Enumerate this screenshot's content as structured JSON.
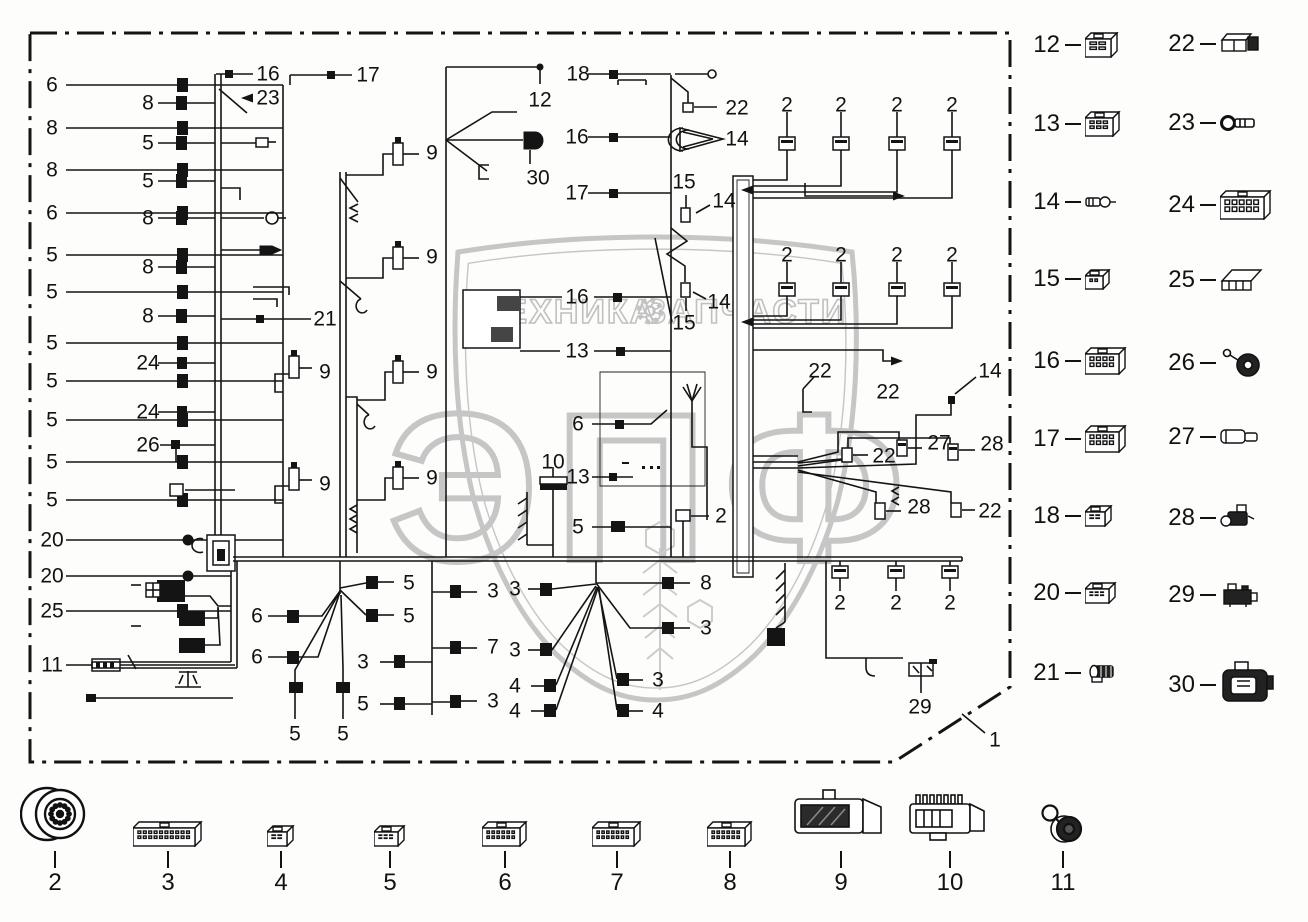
{
  "watermark": {
    "word_left": "ТЕХНИКА",
    "word_right": "ЗАПЧАСТИ",
    "monogram": "ЭПФ",
    "color": "#c6c6c6"
  },
  "diagram": {
    "callouts": [
      {
        "n": "6",
        "x": 52,
        "y": 85
      },
      {
        "n": "8",
        "x": 52,
        "y": 128
      },
      {
        "n": "8",
        "x": 52,
        "y": 170
      },
      {
        "n": "6",
        "x": 52,
        "y": 213
      },
      {
        "n": "5",
        "x": 52,
        "y": 255
      },
      {
        "n": "5",
        "x": 52,
        "y": 292
      },
      {
        "n": "5",
        "x": 52,
        "y": 343
      },
      {
        "n": "5",
        "x": 52,
        "y": 381
      },
      {
        "n": "5",
        "x": 52,
        "y": 420
      },
      {
        "n": "5",
        "x": 52,
        "y": 462
      },
      {
        "n": "5",
        "x": 52,
        "y": 500
      },
      {
        "n": "20",
        "x": 52,
        "y": 540
      },
      {
        "n": "20",
        "x": 52,
        "y": 576
      },
      {
        "n": "25",
        "x": 52,
        "y": 611
      },
      {
        "n": "11",
        "x": 52,
        "y": 665
      },
      {
        "n": "8",
        "x": 148,
        "y": 103
      },
      {
        "n": "5",
        "x": 148,
        "y": 143
      },
      {
        "n": "5",
        "x": 148,
        "y": 181
      },
      {
        "n": "8",
        "x": 148,
        "y": 218
      },
      {
        "n": "8",
        "x": 148,
        "y": 267
      },
      {
        "n": "8",
        "x": 148,
        "y": 316
      },
      {
        "n": "24",
        "x": 148,
        "y": 363
      },
      {
        "n": "24",
        "x": 148,
        "y": 412
      },
      {
        "n": "26",
        "x": 148,
        "y": 445
      },
      {
        "n": "16",
        "x": 268,
        "y": 74
      },
      {
        "n": "23",
        "x": 268,
        "y": 98
      },
      {
        "n": "17",
        "x": 368,
        "y": 75
      },
      {
        "n": "12",
        "x": 540,
        "y": 100
      },
      {
        "n": "30",
        "x": 538,
        "y": 178
      },
      {
        "n": "18",
        "x": 578,
        "y": 74
      },
      {
        "n": "16",
        "x": 577,
        "y": 137
      },
      {
        "n": "17",
        "x": 577,
        "y": 193
      },
      {
        "n": "22",
        "x": 737,
        "y": 108
      },
      {
        "n": "14",
        "x": 737,
        "y": 139
      },
      {
        "n": "15",
        "x": 684,
        "y": 182
      },
      {
        "n": "14",
        "x": 724,
        "y": 201
      },
      {
        "n": "9",
        "x": 432,
        "y": 153
      },
      {
        "n": "9",
        "x": 432,
        "y": 257
      },
      {
        "n": "9",
        "x": 432,
        "y": 372
      },
      {
        "n": "9",
        "x": 432,
        "y": 478
      },
      {
        "n": "9",
        "x": 325,
        "y": 372
      },
      {
        "n": "9",
        "x": 325,
        "y": 484
      },
      {
        "n": "21",
        "x": 325,
        "y": 319
      },
      {
        "n": "16",
        "x": 577,
        "y": 297
      },
      {
        "n": "13",
        "x": 577,
        "y": 351
      },
      {
        "n": "6",
        "x": 578,
        "y": 424
      },
      {
        "n": "13",
        "x": 578,
        "y": 477
      },
      {
        "n": "5",
        "x": 578,
        "y": 527
      },
      {
        "n": "10",
        "x": 553,
        "y": 462
      },
      {
        "n": "2",
        "x": 721,
        "y": 516
      },
      {
        "n": "15",
        "x": 684,
        "y": 323
      },
      {
        "n": "14",
        "x": 719,
        "y": 302
      },
      {
        "n": "2",
        "x": 787,
        "y": 105
      },
      {
        "n": "2",
        "x": 841,
        "y": 105
      },
      {
        "n": "2",
        "x": 897,
        "y": 105
      },
      {
        "n": "2",
        "x": 952,
        "y": 105
      },
      {
        "n": "2",
        "x": 787,
        "y": 255
      },
      {
        "n": "2",
        "x": 841,
        "y": 255
      },
      {
        "n": "2",
        "x": 897,
        "y": 255
      },
      {
        "n": "2",
        "x": 952,
        "y": 255
      },
      {
        "n": "22",
        "x": 820,
        "y": 371
      },
      {
        "n": "22",
        "x": 888,
        "y": 392
      },
      {
        "n": "14",
        "x": 990,
        "y": 371
      },
      {
        "n": "27",
        "x": 939,
        "y": 443
      },
      {
        "n": "28",
        "x": 992,
        "y": 444
      },
      {
        "n": "22",
        "x": 884,
        "y": 456
      },
      {
        "n": "28",
        "x": 919,
        "y": 507
      },
      {
        "n": "22",
        "x": 990,
        "y": 511
      },
      {
        "n": "6",
        "x": 257,
        "y": 616
      },
      {
        "n": "6",
        "x": 257,
        "y": 657
      },
      {
        "n": "5",
        "x": 409,
        "y": 583
      },
      {
        "n": "5",
        "x": 409,
        "y": 616
      },
      {
        "n": "3",
        "x": 363,
        "y": 662
      },
      {
        "n": "5",
        "x": 363,
        "y": 704
      },
      {
        "n": "5",
        "x": 295,
        "y": 734
      },
      {
        "n": "5",
        "x": 343,
        "y": 734
      },
      {
        "n": "3",
        "x": 493,
        "y": 591
      },
      {
        "n": "3",
        "x": 515,
        "y": 589
      },
      {
        "n": "7",
        "x": 493,
        "y": 647
      },
      {
        "n": "3",
        "x": 515,
        "y": 650
      },
      {
        "n": "3",
        "x": 493,
        "y": 701
      },
      {
        "n": "4",
        "x": 515,
        "y": 686
      },
      {
        "n": "4",
        "x": 515,
        "y": 711
      },
      {
        "n": "8",
        "x": 706,
        "y": 583
      },
      {
        "n": "3",
        "x": 706,
        "y": 628
      },
      {
        "n": "3",
        "x": 658,
        "y": 680
      },
      {
        "n": "4",
        "x": 658,
        "y": 711
      },
      {
        "n": "2",
        "x": 840,
        "y": 603
      },
      {
        "n": "2",
        "x": 896,
        "y": 603
      },
      {
        "n": "2",
        "x": 950,
        "y": 603
      },
      {
        "n": "29",
        "x": 920,
        "y": 707
      },
      {
        "n": "1",
        "x": 995,
        "y": 740
      }
    ]
  },
  "legend_right": {
    "rows": [
      {
        "y": 54,
        "left": {
          "n": "12",
          "icon": "connector-4pin"
        },
        "right": {
          "n": "22",
          "icon": "connector-2piece"
        }
      },
      {
        "y": 133,
        "left": {
          "n": "13",
          "icon": "connector-6pin"
        },
        "right": {
          "n": "23",
          "icon": "ring-terminal"
        }
      },
      {
        "y": 212,
        "left": {
          "n": "14",
          "icon": "bullet-terminal"
        },
        "right": {
          "n": "24",
          "icon": "connector-10pin"
        }
      },
      {
        "y": 289,
        "left": {
          "n": "15",
          "icon": "connector-2pin"
        },
        "right": {
          "n": "25",
          "icon": "connector-cover"
        }
      },
      {
        "y": 369,
        "left": {
          "n": "16",
          "icon": "connector-8pin"
        },
        "right": {
          "n": "26",
          "icon": "grommet"
        }
      },
      {
        "y": 447,
        "left": {
          "n": "17",
          "icon": "connector-8pin"
        },
        "right": {
          "n": "27",
          "icon": "terminal-sleeve"
        }
      },
      {
        "y": 526,
        "left": {
          "n": "18",
          "icon": "connector-4pin-small"
        },
        "right": {
          "n": "28",
          "icon": "sealed-plug"
        }
      },
      {
        "y": 603,
        "left": {
          "n": "20",
          "icon": "connector-6pin-small"
        },
        "right": {
          "n": "29",
          "icon": "relay-bracket"
        }
      },
      {
        "y": 682,
        "left": {
          "n": "21",
          "icon": "sealed-connector"
        },
        "right": {
          "n": "30",
          "icon": "large-housing"
        }
      }
    ]
  },
  "legend_bottom": {
    "items": [
      {
        "n": "2",
        "icon": "round-connector",
        "x": 55
      },
      {
        "n": "3",
        "icon": "connector-20pin",
        "x": 168
      },
      {
        "n": "4",
        "icon": "connector-4pin-small",
        "x": 281
      },
      {
        "n": "5",
        "icon": "connector-6pin-small",
        "x": 390
      },
      {
        "n": "6",
        "icon": "connector-12pin",
        "x": 505
      },
      {
        "n": "7",
        "icon": "connector-14pin",
        "x": 617
      },
      {
        "n": "8",
        "icon": "connector-12pin",
        "x": 730
      },
      {
        "n": "9",
        "icon": "housing-with-cover",
        "x": 841
      },
      {
        "n": "10",
        "icon": "housing-with-pins",
        "x": 950
      },
      {
        "n": "11",
        "icon": "round-cap",
        "x": 1063
      }
    ]
  }
}
